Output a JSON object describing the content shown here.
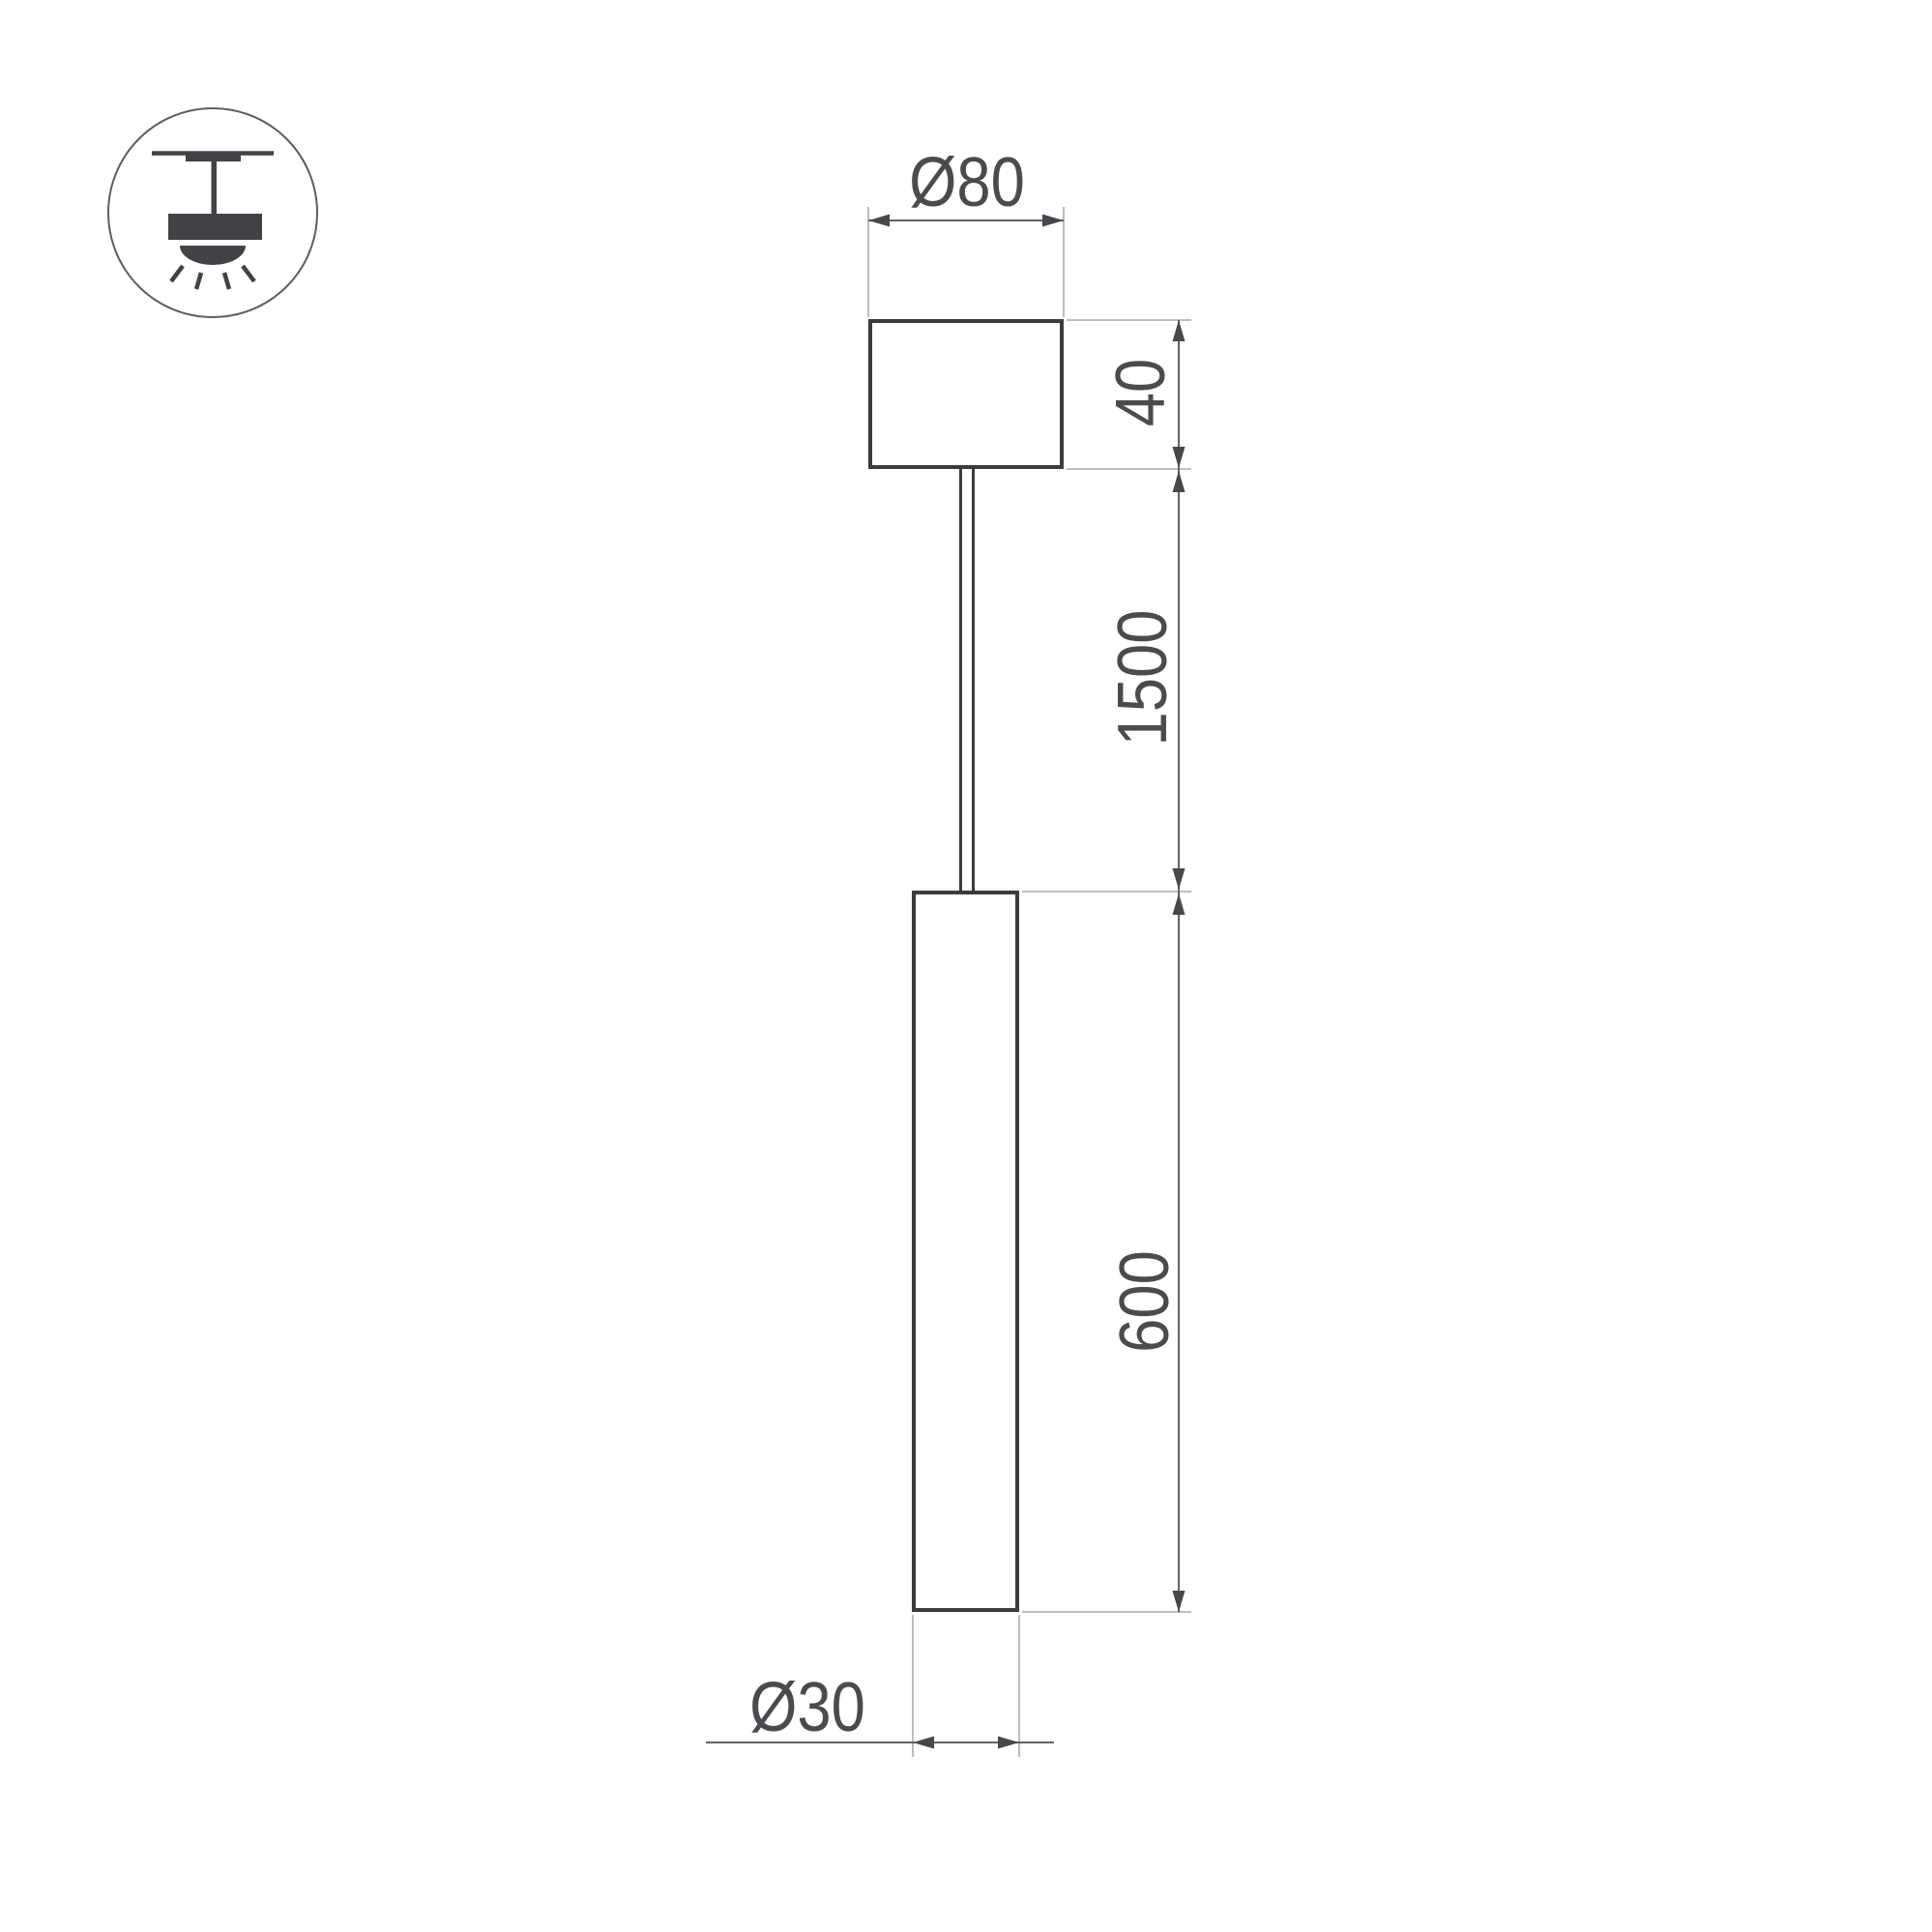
{
  "page": {
    "background": "#ffffff",
    "description": "Technical dimension drawing of a suspended LED tube pendant luminaire"
  },
  "colors": {
    "background": "#ffffff",
    "outline": "#3b3c3e",
    "ext": "#a6a7aa",
    "dim": "#626366",
    "arrow": "#47484b",
    "icon": "#414245",
    "iconcircle": "#5c5d60",
    "text": "#4a4b4e"
  },
  "icon": {
    "name": "pendant-lamp-mounting-icon"
  },
  "drawing": {
    "labels": {
      "canopy_diameter": "Ø80",
      "canopy_height": "40",
      "suspension_length": "1500",
      "tube_length": "600",
      "tube_diameter": "Ø30"
    }
  }
}
